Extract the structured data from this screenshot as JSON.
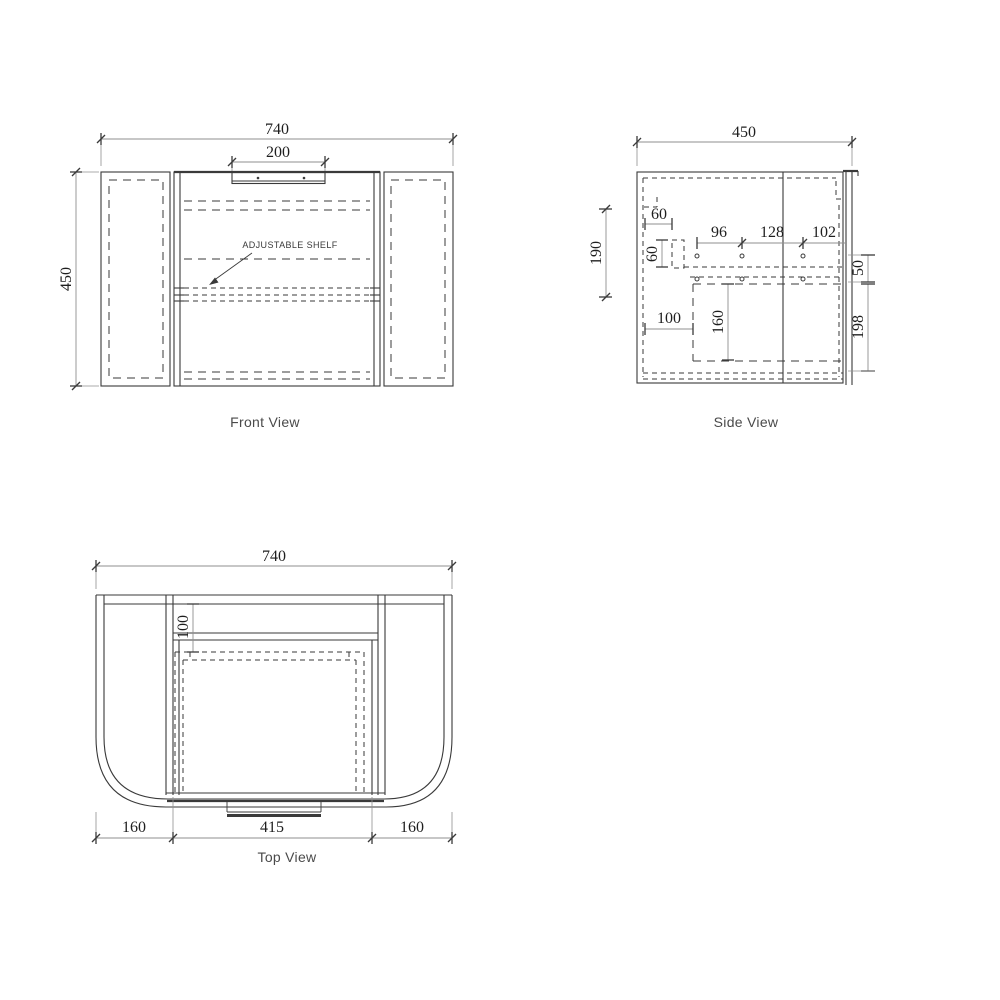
{
  "colors": {
    "line": "#3a3a3a",
    "dim_line": "#8f8f8f",
    "dim_text": "#1e1e1e",
    "caption": "#4a4a4a",
    "bg": "#ffffff"
  },
  "front_view": {
    "caption": "Front View",
    "shelf_label": "ADJUSTABLE SHELF",
    "dims": {
      "overall_width": "740",
      "recess_width": "200",
      "overall_height": "450"
    }
  },
  "side_view": {
    "caption": "Side View",
    "dims": {
      "overall_depth": "450",
      "rail_offset": "60",
      "rail_height": "60",
      "hole_span_a": "96",
      "hole_span_b": "128",
      "hole_span_c": "102",
      "left_height": "190",
      "top_gap": "50",
      "basin_offset": "100",
      "basin_height": "160",
      "bottom_height": "198"
    }
  },
  "top_view": {
    "caption": "Top View",
    "dims": {
      "overall_width": "740",
      "back_depth": "100",
      "left_wing": "160",
      "opening_width": "415",
      "right_wing": "160"
    }
  }
}
